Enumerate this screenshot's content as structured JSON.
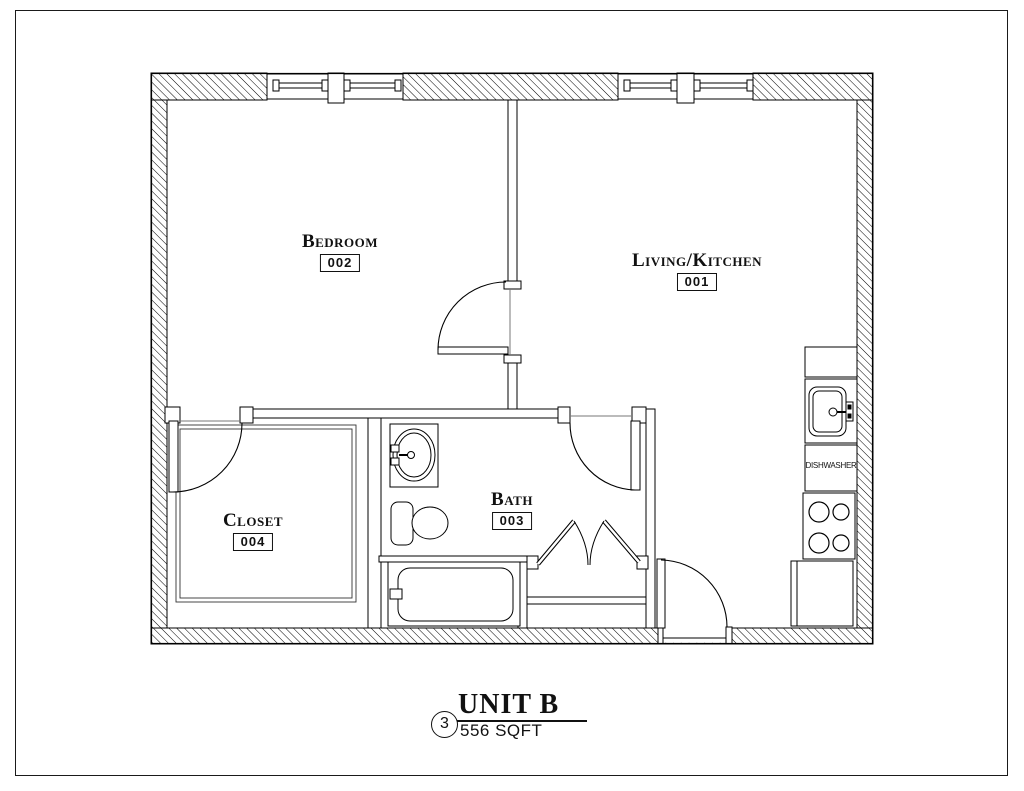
{
  "colors": {
    "line": "#000000",
    "background": "#ffffff"
  },
  "rooms": [
    {
      "name": "Bedroom",
      "number": "002"
    },
    {
      "name": "Living/Kitchen",
      "number": "001"
    },
    {
      "name": "Bath",
      "number": "003"
    },
    {
      "name": "Closet",
      "number": "004"
    }
  ],
  "labels": {
    "dishwasher": "DISHWASHER"
  },
  "title_block": {
    "detail_number": "3",
    "title": "UNIT B",
    "area": "556 SQFT"
  }
}
